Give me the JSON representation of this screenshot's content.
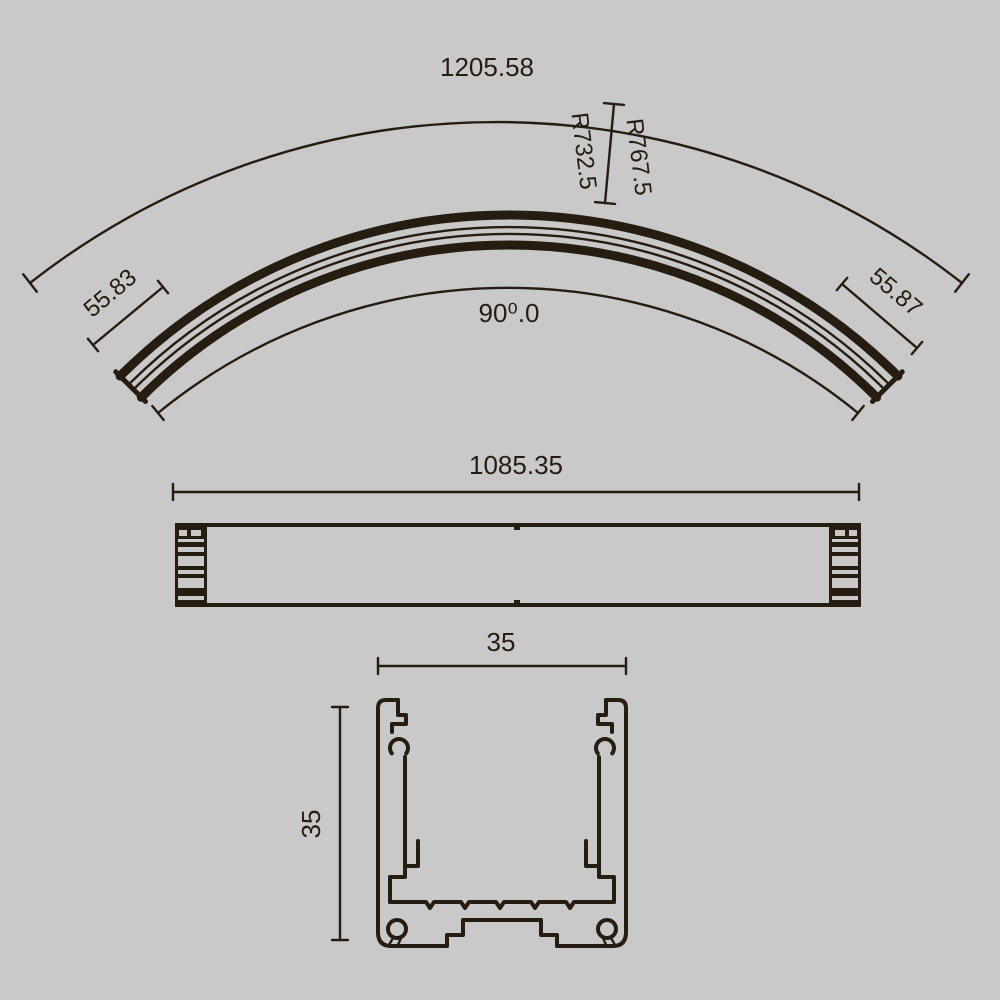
{
  "colors": {
    "background": "#c9c9c9",
    "ink": "#261d10"
  },
  "drawing": {
    "curved_view": {
      "chord_length": "1205.58",
      "radius_outer": "R767.5",
      "radius_inner": "R732.5",
      "arc_angle": "90⁰.0",
      "end_width_left": "55.83",
      "end_width_right": "55.87"
    },
    "side_view": {
      "length": "1085.35"
    },
    "section_view": {
      "width": "35",
      "height": "35"
    }
  }
}
